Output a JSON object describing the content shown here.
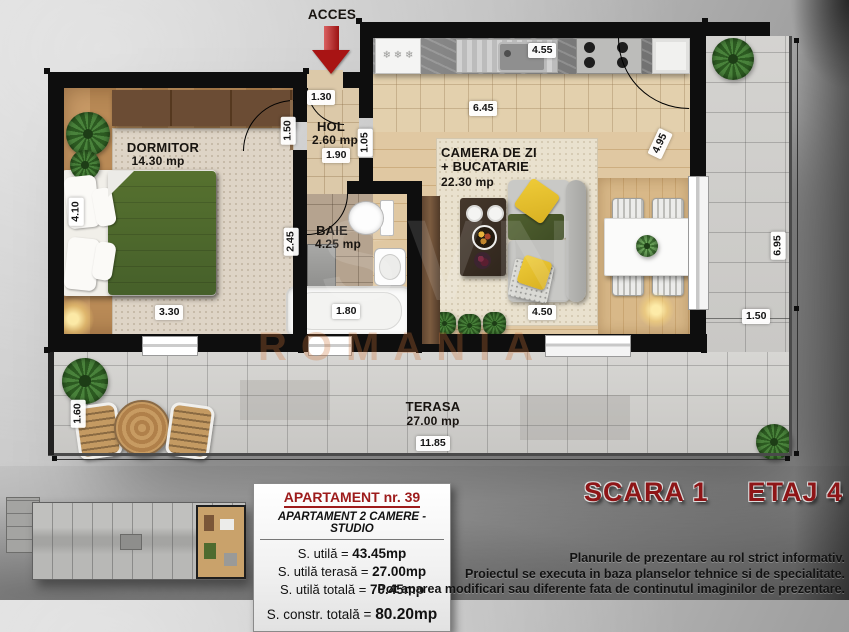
{
  "access": {
    "label": "ACCES"
  },
  "watermark": {
    "logo": "SVN",
    "country": "ROMANIA"
  },
  "rooms": {
    "dormitor": {
      "name": "DORMITOR",
      "area": "14.30 mp"
    },
    "hol": {
      "name": "HOL",
      "area": "2.60 mp"
    },
    "baie": {
      "name": "BAIE",
      "area": "4.25 mp"
    },
    "living": {
      "name1": "CAMERA DE ZI",
      "name2": "+ BUCATARIE",
      "area": "22.30 mp"
    },
    "terasa": {
      "name": "TERASA",
      "area": "27.00 mp"
    }
  },
  "dims": {
    "acces_width": "1.30",
    "hol_left": "1.50",
    "hol_width": "1.90",
    "hol_right": "1.05",
    "dormitor_height": "4.10",
    "dormitor_width": "3.30",
    "baie_left": "2.45",
    "bathtub": "1.80",
    "kitchen_counter": "4.55",
    "living_top": "6.45",
    "living_door": "4.95",
    "living_bottom": "4.50",
    "terasa_right_height": "6.95",
    "terasa_right_width": "1.50",
    "terasa_left_width": "1.60",
    "terasa_length": "11.85"
  },
  "info": {
    "title": "APARTAMENT nr. 39",
    "subtitle": "APARTAMENT 2 CAMERE - STUDIO",
    "rows": [
      {
        "label": "S. utilă = ",
        "value": "43.45mp"
      },
      {
        "label": "S. utilă terasă = ",
        "value": "27.00mp"
      },
      {
        "label": "S. utilă totală = ",
        "value": "70.45mp"
      }
    ],
    "total_label": "S. constr. totală = ",
    "total_value": "80.20mp"
  },
  "footer": {
    "scara": "SCARA 1",
    "etaj": "ETAJ 4",
    "disclaimer1": "Planurile de prezentare au rol strict informativ.",
    "disclaimer2": "Proiectul se executa in baza planselor tehnice si de specialitate.",
    "disclaimer3": "Pot aparea modificari sau diferente fata de continutul imaginilor de prezentare."
  },
  "colors": {
    "accent_red": "#9d1b1b",
    "wall": "#0e0e0e",
    "arrow_red": "#a81414"
  }
}
